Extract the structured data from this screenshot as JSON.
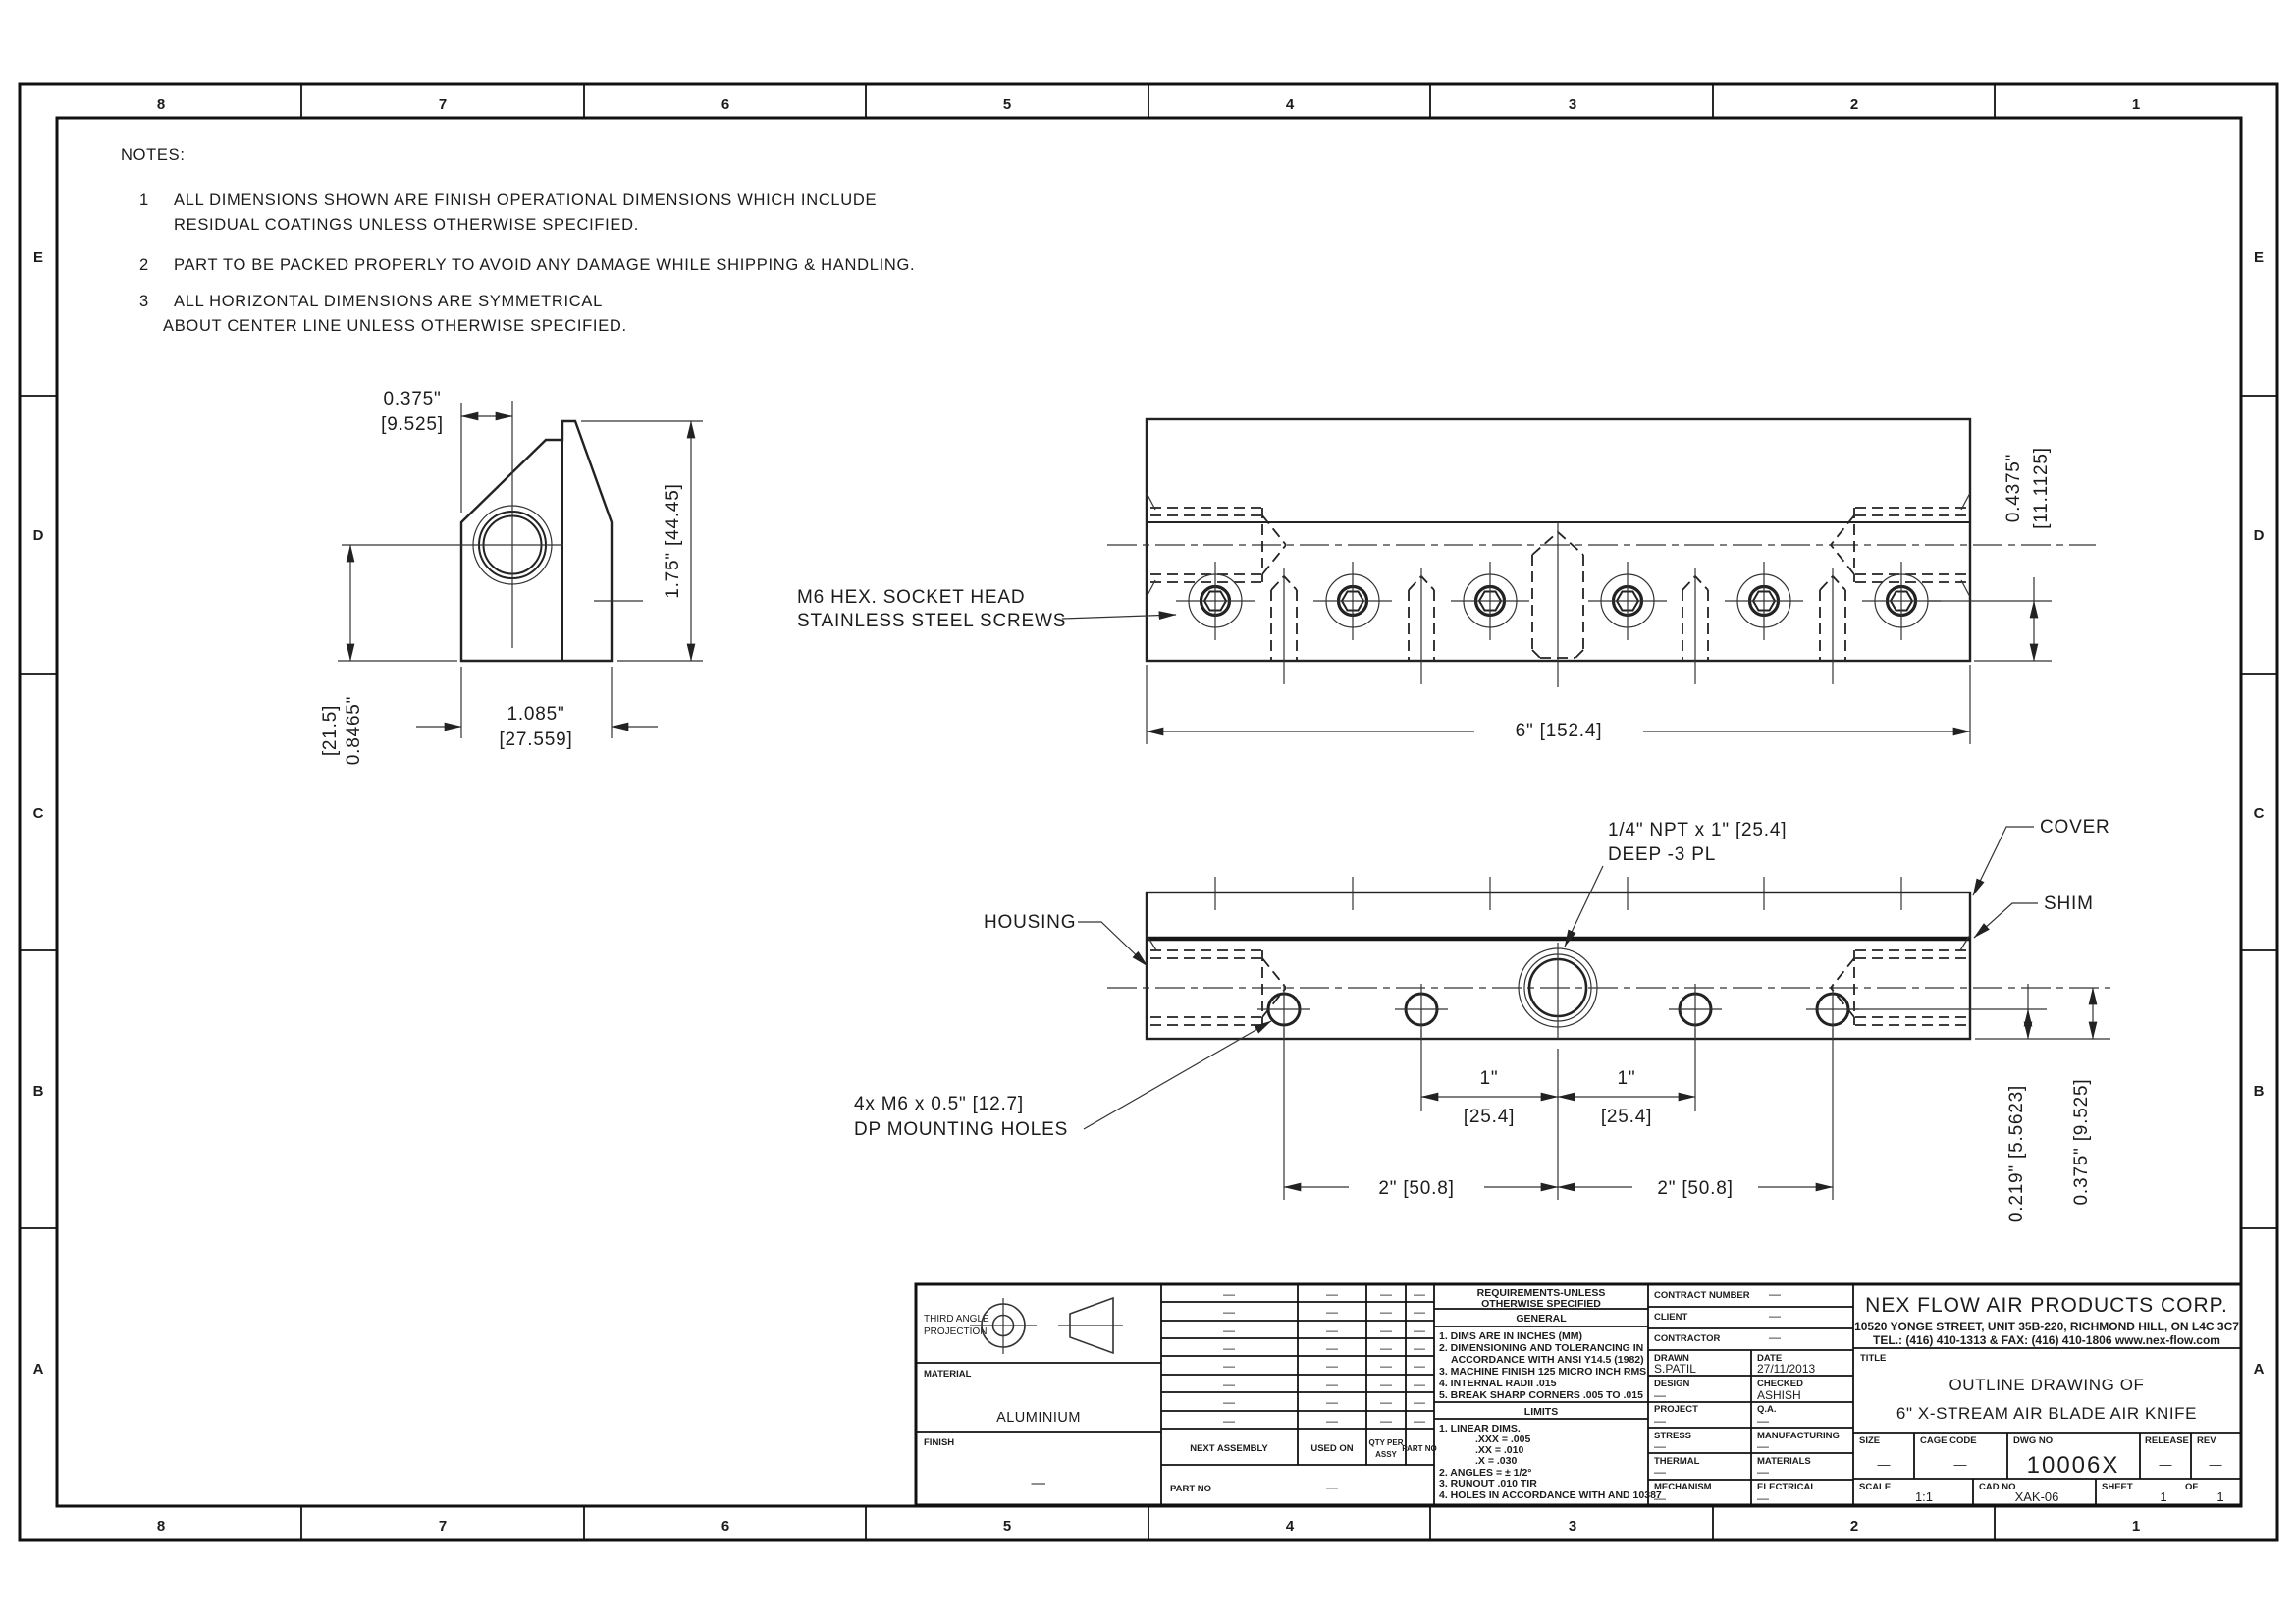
{
  "border": {
    "cols": [
      "8",
      "7",
      "6",
      "5",
      "4",
      "3",
      "2",
      "1"
    ],
    "rows": [
      "E",
      "D",
      "C",
      "B",
      "A"
    ]
  },
  "notes": {
    "heading": "NOTES:",
    "n1_num": "1",
    "n1a": "ALL DIMENSIONS SHOWN ARE FINISH OPERATIONAL DIMENSIONS WHICH INCLUDE",
    "n1b": "RESIDUAL COATINGS UNLESS OTHERWISE SPECIFIED.",
    "n2_num": "2",
    "n2a": "PART TO BE PACKED PROPERLY TO AVOID ANY DAMAGE WHILE SHIPPING & HANDLING.",
    "n3_num": "3",
    "n3a": "ALL HORIZONTAL DIMENSIONS ARE SYMMETRICAL",
    "n3b": "ABOUT CENTER LINE UNLESS OTHERWISE SPECIFIED."
  },
  "side_view": {
    "dim_width_top": "0.375\"",
    "dim_width_top_mm": "[9.525]",
    "dim_height": "1.75\"  [44.45]",
    "dim_center_in": "0.8465\"",
    "dim_center_mm": "[21.5]",
    "dim_depth": "1.085\"",
    "dim_depth_mm": "[27.559]"
  },
  "rear_view": {
    "screw_note_1": "M6 HEX. SOCKET HEAD",
    "screw_note_2": "STAINLESS STEEL SCREWS",
    "dim_screw_in": "0.4375\"",
    "dim_screw_mm": "[11.1125]",
    "dim_length": "6\" [152.4]"
  },
  "bottom_view": {
    "npt_note_1": "1/4\" NPT x 1\" [25.4]",
    "npt_note_2": "DEEP -3 PL",
    "cover_label": "COVER",
    "shim_label": "SHIM",
    "housing_label": "HOUSING",
    "mount_note_1": "4x M6 x 0.5\" [12.7]",
    "mount_note_2": "DP MOUNTING HOLES",
    "dim_1in_a": "1\"",
    "dim_1in_a_mm": "[25.4]",
    "dim_1in_b": "1\"",
    "dim_1in_b_mm": "[25.4]",
    "dim_2in_a": "2\" [50.8]",
    "dim_2in_b": "2\" [50.8]",
    "dim_hole_offset": "0.219\" [5.5623]",
    "dim_edge_offset": "0.375\" [9.525]"
  },
  "title_block": {
    "projection": {
      "label_1": "THIRD ANGLE",
      "label_2": "PROJECTION"
    },
    "material": {
      "label": "MATERIAL",
      "value": "ALUMINIUM"
    },
    "finish": {
      "label": "FINISH",
      "value": "—"
    },
    "parts_list": {
      "dash": "—",
      "col_next_assembly": "NEXT ASSEMBLY",
      "col_used_on": "USED ON",
      "col_qty_1": "QTY PER",
      "col_qty_2": "ASSY",
      "col_part_no": "PART NO",
      "part_no_label": "PART NO",
      "part_no_value": "—"
    },
    "requirements": {
      "header_1": "REQUIREMENTS-UNLESS",
      "header_2": "OTHERWISE SPECIFIED",
      "general_header": "GENERAL",
      "general": [
        "1. DIMS ARE IN INCHES (MM)",
        "2. DIMENSIONING AND TOLERANCING IN",
        "ACCORDANCE WITH ANSI Y14.5 (1982)",
        "3. MACHINE FINISH 125 MICRO INCH RMS",
        "4. INTERNAL RADII .015",
        "5. BREAK SHARP CORNERS .005 TO .015"
      ],
      "limits_header": "LIMITS",
      "limits": [
        "1. LINEAR DIMS.",
        ".XXX = .005",
        ".XX  = .010",
        ".X   = .030",
        "2. ANGLES  = ± 1/2°",
        "3. RUNOUT .010 TIR",
        "4. HOLES IN ACCORDANCE WITH AND 10387"
      ]
    },
    "contract": {
      "contract_number_label": "CONTRACT NUMBER",
      "contract_number": "—",
      "client_label": "CLIENT",
      "client": "—",
      "contractor_label": "CONTRACTOR",
      "contractor": "—"
    },
    "signoff": {
      "drawn_label": "DRAWN",
      "drawn": "S.PATIL",
      "date_label": "DATE",
      "date": "27/11/2013",
      "design_label": "DESIGN",
      "design": "—",
      "checked_label": "CHECKED",
      "checked": "ASHISH",
      "project_label": "PROJECT",
      "project": "—",
      "qa_label": "Q.A.",
      "qa": "—",
      "stress_label": "STRESS",
      "stress": "—",
      "manufacturing_label": "MANUFACTURING",
      "manufacturing": "—",
      "thermal_label": "THERMAL",
      "thermal": "—",
      "materials_label": "MATERIALS",
      "materials": "—",
      "mechanism_label": "MECHANISM",
      "mechanism": "—",
      "electrical_label": "ELECTRICAL",
      "electrical": "—"
    },
    "company": {
      "name": "NEX FLOW AIR PRODUCTS CORP.",
      "address": "10520 YONGE STREET, UNIT 35B-220, RICHMOND HILL, ON L4C 3C7",
      "phone": "TEL.: (416) 410-1313 & FAX: (416) 410-1806 www.nex-flow.com"
    },
    "title": {
      "label": "TITLE",
      "line_1": "OUTLINE DRAWING OF",
      "line_2": "6\" X-STREAM AIR BLADE AIR KNIFE"
    },
    "doc": {
      "size_label": "SIZE",
      "size": "—",
      "cage_label": "CAGE CODE",
      "cage": "—",
      "dwg_label": "DWG NO",
      "dwg_no": "10006X",
      "release_label": "RELEASE",
      "release": "—",
      "rev_label": "REV",
      "rev": "—",
      "scale_label": "SCALE",
      "scale": "1:1",
      "cad_label": "CAD NO",
      "cad_no": "XAK-06",
      "sheet_label": "SHEET",
      "sheet": "1",
      "of_label": "OF",
      "of": "1"
    }
  }
}
